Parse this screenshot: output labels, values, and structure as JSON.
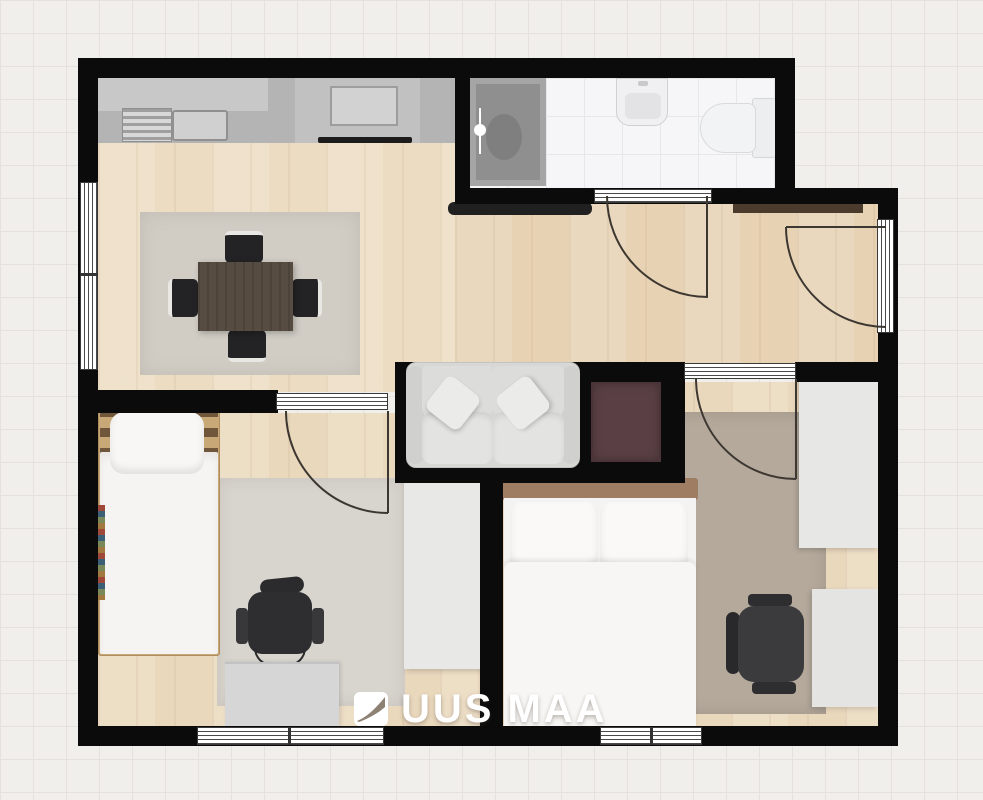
{
  "brand": {
    "word1": "UUS",
    "word2": "MAA",
    "full": "UUS MAA",
    "logo_icon": "uusmaa-swoosh-square"
  },
  "plan": {
    "type": "apartment-floorplan-top-view",
    "rooms": [
      {
        "name": "kitchen-living-room",
        "furniture": [
          "kitchen-counter",
          "upper-cabinets",
          "kitchen-sink",
          "stove-cooktop",
          "dining-table",
          "dining-chair-top",
          "dining-chair-bottom",
          "dining-chair-left",
          "dining-chair-right",
          "area-rug",
          "sofa"
        ]
      },
      {
        "name": "bathroom",
        "furniture": [
          "shower",
          "washbasin",
          "toilet"
        ]
      },
      {
        "name": "hallway",
        "furniture": [
          "bench",
          "wall-shelf"
        ]
      },
      {
        "name": "bedroom-1",
        "furniture": [
          "single-bed",
          "pillow",
          "office-chair",
          "desk",
          "wardrobe",
          "area-rug"
        ]
      },
      {
        "name": "bedroom-2",
        "furniture": [
          "double-bed",
          "pillows",
          "office-chair",
          "desk",
          "wardrobe",
          "area-rug"
        ]
      }
    ],
    "openings": {
      "windows": 3,
      "interior_doors": 3,
      "entry_door": 1
    },
    "misc": [
      "maroon-panel-niche"
    ]
  },
  "colors": {
    "background": "#f1efeb",
    "grid_line": "#e5e2db",
    "wall": "#0b0b0b",
    "wood_living": "#ecdcc2",
    "wood_hall": "#e7d2b3",
    "wood_bedroom": "#ead8bd",
    "bath_tile": "#f6f6f8",
    "rug_living": "#d1cdc5",
    "rug_bedroom1": "#d8d4ce",
    "rug_bedroom2": "#b5a99c",
    "counter_gray": "#b4b4b4",
    "table_brown": "#564c42",
    "chair_black": "#2e2e30",
    "maroon_panel": "#5a4045",
    "shelf_brown": "#4a3b2d",
    "white_furniture": "#f4f3f1",
    "watermark": "#ffffff"
  }
}
